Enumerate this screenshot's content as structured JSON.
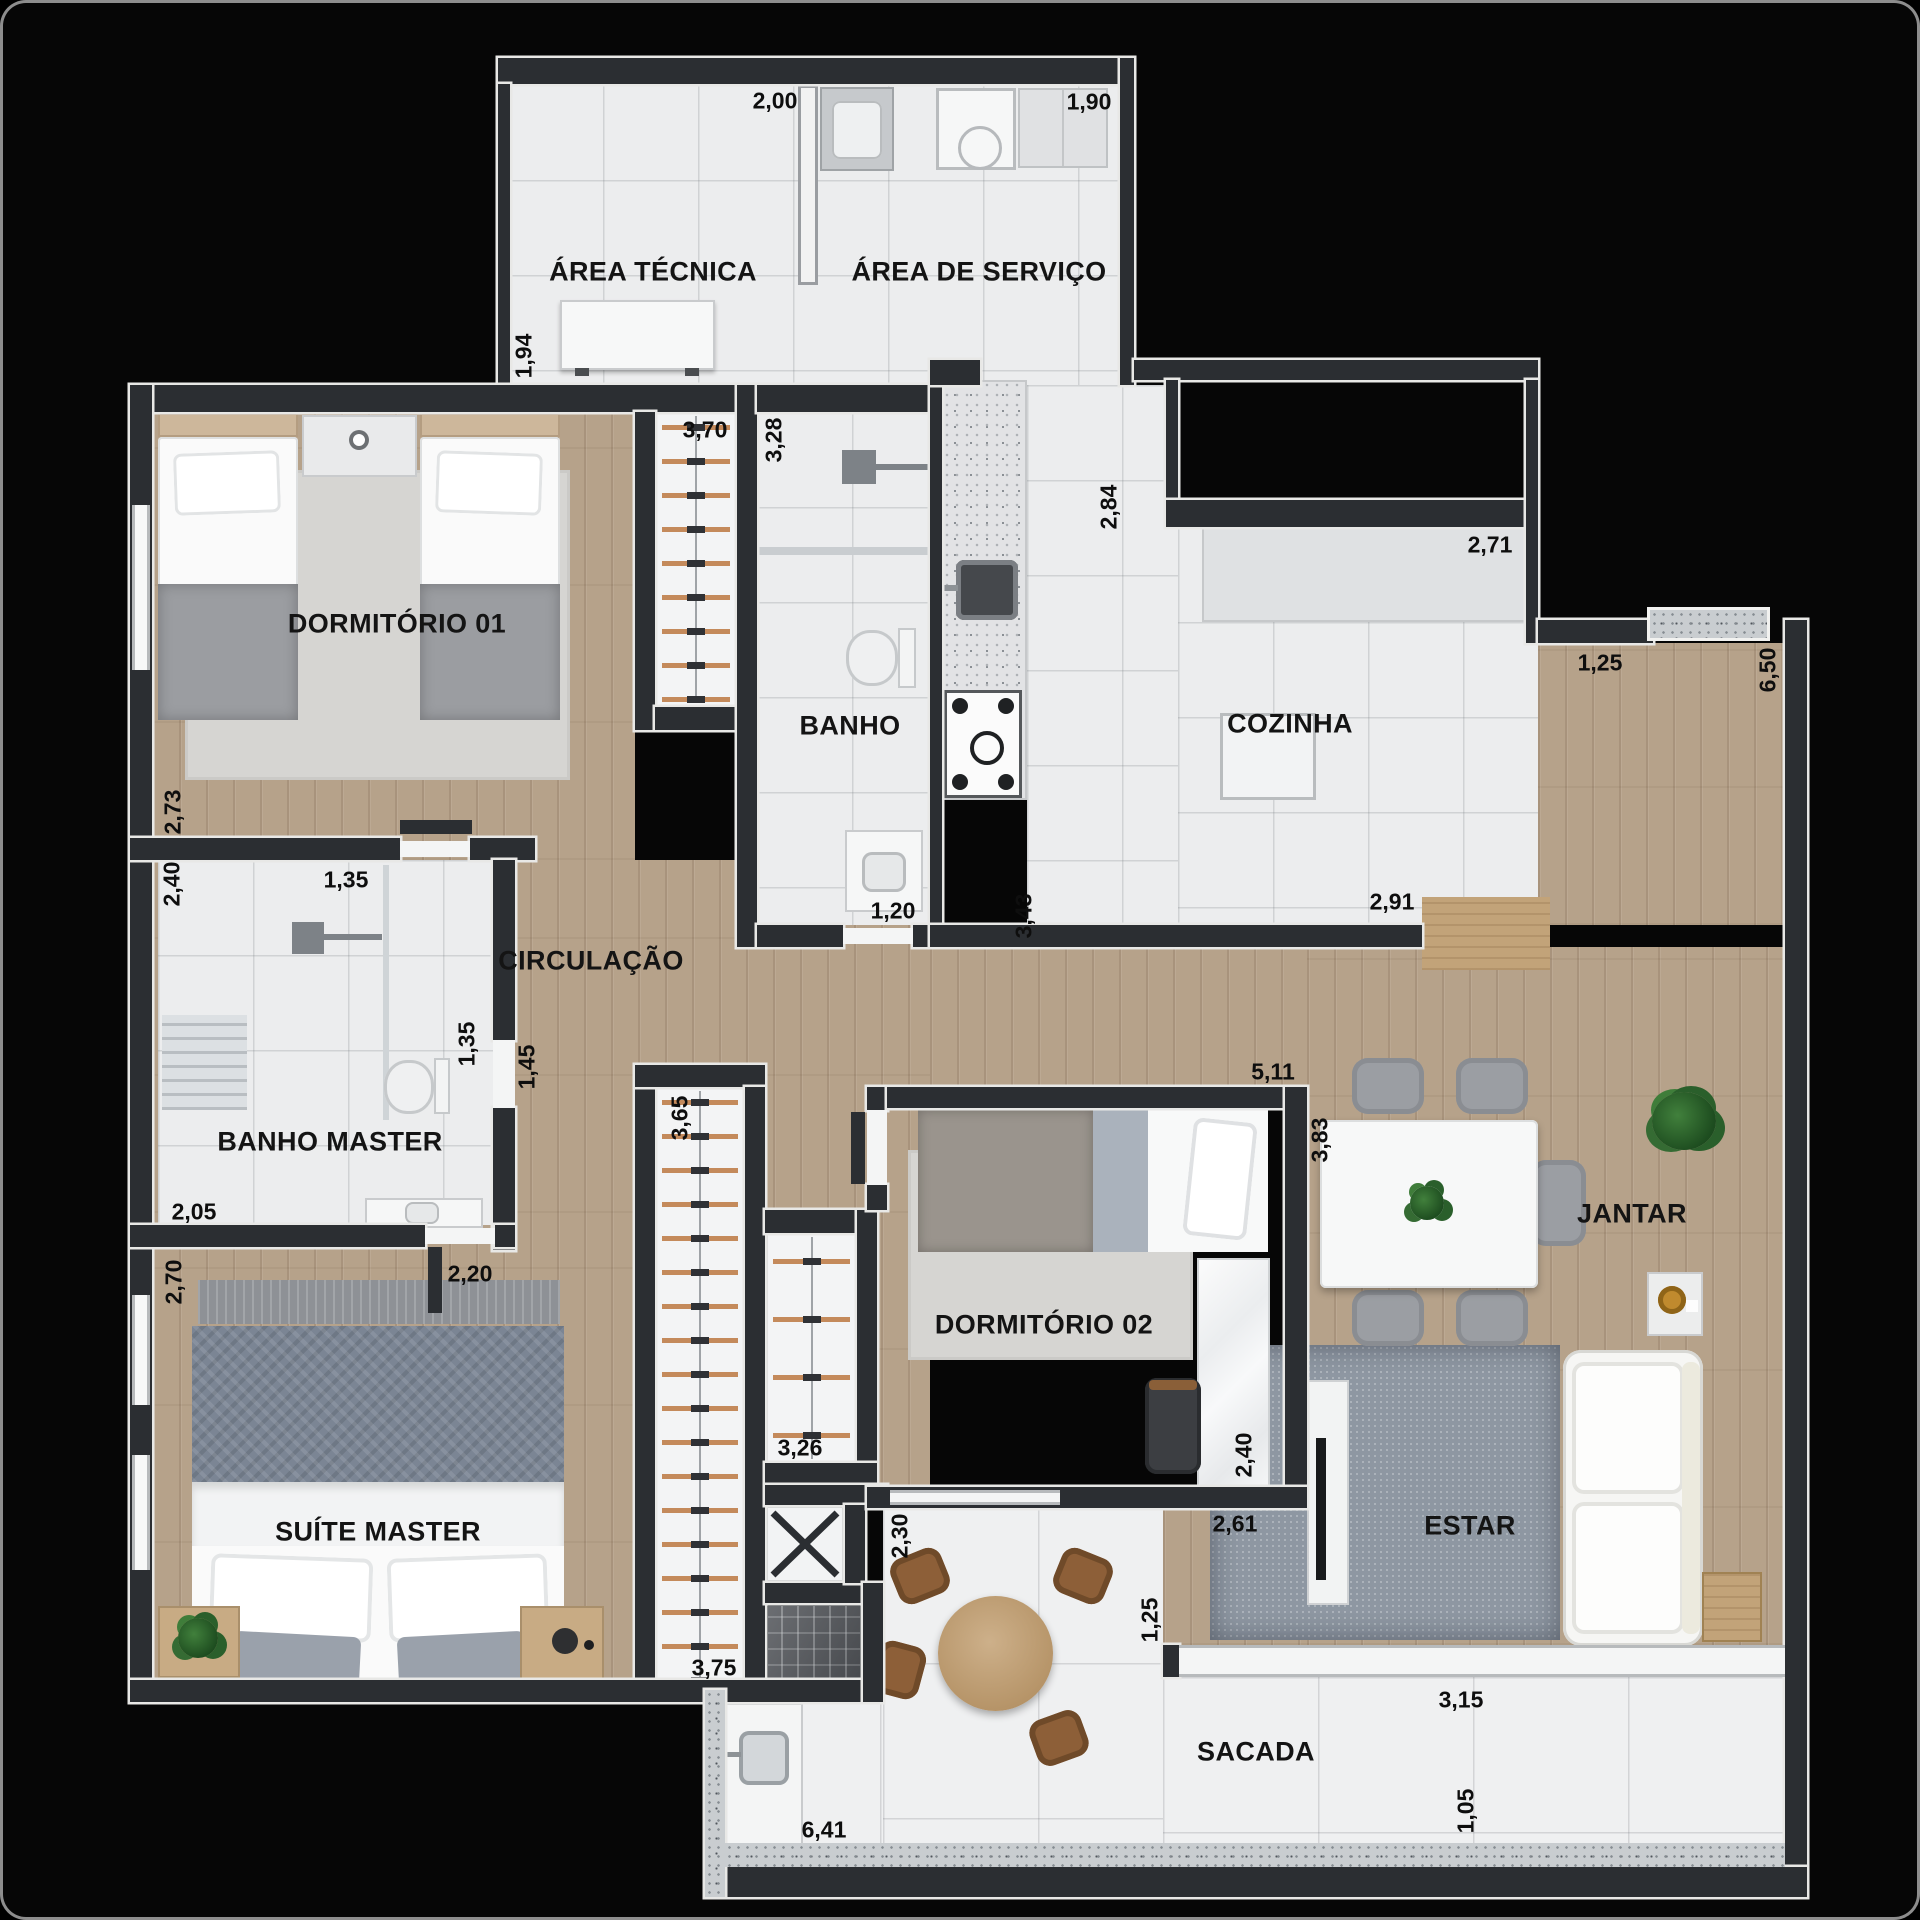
{
  "plan_title": "Apartment floor plan",
  "colors": {
    "background": "#000000",
    "wall": "#2b2e32",
    "wall_trim": "#e8e8e6",
    "wood_floor": "#b6a28a",
    "tile_floor": "#ecedee",
    "label_text": "#141414",
    "closet_rod": "#c48a5b",
    "estar_rug": "#8e97a2",
    "balcony_chair": "#8d5f38"
  },
  "rooms": {
    "area_tecnica": {
      "label": "ÁREA TÉCNICA"
    },
    "area_servico": {
      "label": "ÁREA DE SERVIÇO"
    },
    "dormitorio_01": {
      "label": "DORMITÓRIO 01"
    },
    "banho": {
      "label": "BANHO"
    },
    "cozinha": {
      "label": "COZINHA"
    },
    "circulacao": {
      "label": "CIRCULAÇÃO"
    },
    "banho_master": {
      "label": "BANHO MASTER"
    },
    "suite_master": {
      "label": "SUÍTE MASTER"
    },
    "dormitorio_02": {
      "label": "DORMITÓRIO 02"
    },
    "jantar": {
      "label": "JANTAR"
    },
    "estar": {
      "label": "ESTAR"
    },
    "sacada": {
      "label": "SACADA"
    }
  },
  "dims": {
    "d200": "2,00",
    "d190": "1,90",
    "d194": "1,94",
    "d370": "3,70",
    "d328": "3,28",
    "d284": "2,84",
    "d271": "2,71",
    "d125_entry": "1,25",
    "d650": "6,50",
    "d273": "2,73",
    "d240_bm": "2,40",
    "d135_shower": "1,35",
    "d135_wc": "1,35",
    "d145": "1,45",
    "d205": "2,05",
    "d270": "2,70",
    "d220": "2,20",
    "d120": "1,20",
    "d343": "3,43",
    "d291": "2,91",
    "d511": "5,11",
    "d383": "3,83",
    "d365": "3,65",
    "d326": "3,26",
    "d240_d2": "2,40",
    "d261": "2,61",
    "d230": "2,30",
    "d375": "3,75",
    "d641": "6,41",
    "d125_estar": "1,25",
    "d315": "3,15",
    "d105": "1,05"
  }
}
